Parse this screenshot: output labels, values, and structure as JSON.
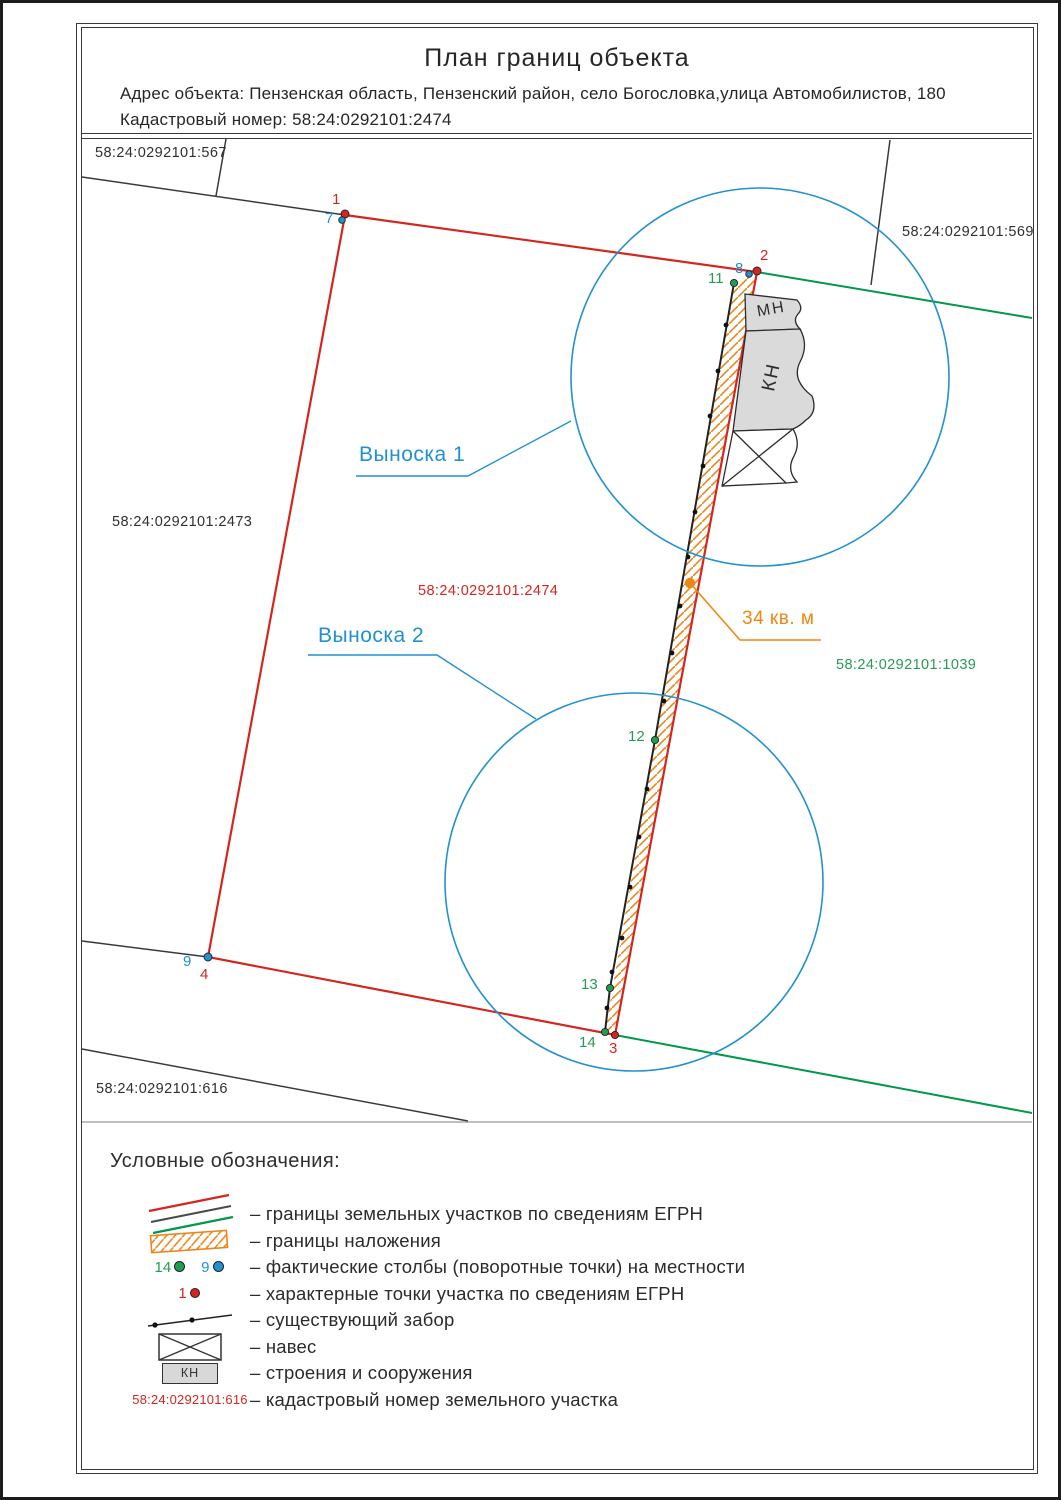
{
  "colors": {
    "egrn_red": "#d4261f",
    "neighbor_green": "#00984a",
    "callout_blue": "#2191d0",
    "overlap_orange": "#ee8712",
    "building_gray": "#d8d8d8"
  },
  "title_block": {
    "title": "План границ объекта",
    "address_line": "Адрес объекта: Пензенская область, Пензенский район, село Богословка,улица Автомобилистов, 180",
    "cadastral_line": "Кадастровый номер: 58:24:0292101:2474"
  },
  "map": {
    "cadastral_labels": {
      "l567": "58:24:0292101:567",
      "l569": "58:24:0292101:569",
      "l2473": "58:24:0292101:2473",
      "l2474": "58:24:0292101:2474",
      "l1039": "58:24:0292101:1039",
      "l616": "58:24:0292101:616"
    },
    "callouts": {
      "c1": "Выноска 1",
      "c2": "Выноска 2"
    },
    "overlap_area_label": "34 кв. м",
    "buildings": {
      "mn": "МН",
      "kn": "КН"
    },
    "points": {
      "p1": "1",
      "p2": "2",
      "p3": "3",
      "p4": "4",
      "p7": "7",
      "p8": "8",
      "p9": "9",
      "p11": "11",
      "p12": "12",
      "p13": "13",
      "p14": "14"
    }
  },
  "legend": {
    "heading": "Условные обозначения:",
    "items": [
      {
        "label": "– границы земельных участков по сведениям ЕГРН"
      },
      {
        "label": "– границы наложения"
      },
      {
        "label": "– фактические столбы (поворотные точки) на местности",
        "num_green": "14",
        "num_blue": "9"
      },
      {
        "label": "– характерные точки участка по сведениям ЕГРН",
        "num_red": "1"
      },
      {
        "label": "– существующий забор"
      },
      {
        "label": "– навес"
      },
      {
        "label": "– строения и сооружения",
        "swatch_text": "КН"
      },
      {
        "label": "– кадастровый номер земельного участка",
        "swatch_text": "58:24:0292101:616"
      }
    ]
  }
}
